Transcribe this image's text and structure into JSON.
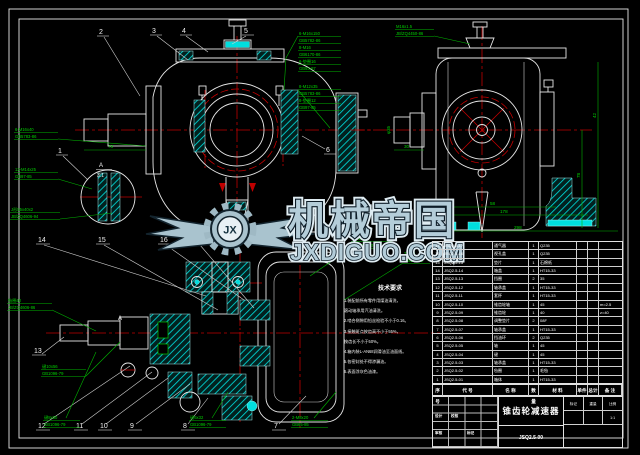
{
  "colors": {
    "background": "#000000",
    "outline": "#e6e6e6",
    "centerline": "#c00000",
    "annotation_green": "#00d000",
    "hatch_cyan": "#00dede",
    "watermark_blue": "#b4cdd9"
  },
  "watermark": {
    "brand": "机械帝国",
    "site": "JXDIGUO.COM",
    "monogram": "JX"
  },
  "views": {
    "front": {
      "balloons": [
        "1",
        "2",
        "3",
        "4",
        "5",
        "6"
      ],
      "detail": {
        "letter": "A",
        "scale": "3:1"
      },
      "dim_shaft": "78",
      "callouts": {
        "left1": [
          "6-M16x40",
          "GB5783-86"
        ],
        "left2": [
          "12-M14x25",
          "GB97-85"
        ],
        "left3": [
          "J形55x40x2",
          "JB/ZQ4606-94"
        ],
        "mid1": [
          "6-M16x150",
          "GB5782-86",
          "8-M16",
          "GB6170-86",
          "6-垫圈16",
          "GB93-87"
        ],
        "mid2": [
          "8-M12x35",
          "GB5783-86",
          "8-垫圈12",
          "GB97-85"
        ]
      }
    },
    "side": {
      "cap_callout": [
        "M16x1.5",
        "JB/ZQ4450-86"
      ],
      "dims": {
        "d42": "42",
        "d78": "78",
        "d58": "58",
        "d178": "178",
        "d298": "298",
        "d30": "30",
        "dphi": "φ35"
      }
    },
    "plan": {
      "section_label": "A",
      "balloon_13": "13",
      "balloons_top": [
        "14",
        "15",
        "16",
        "17"
      ],
      "balloons_bottom": [
        "12",
        "11",
        "10",
        "9",
        "8",
        "7"
      ],
      "callouts": {
        "left1": [
          "毡圈40",
          "JB/ZQ4606-86"
        ],
        "left2": [
          "键10x56",
          "GB1096-79"
        ],
        "bot1": [
          "键8x50",
          "GB1096-79"
        ],
        "bot2": [
          "键6x32",
          "GB1096-79"
        ],
        "bot3": [
          "2-M8x20",
          "GB65-85"
        ],
        "right1": [
          "M14x1.5",
          "JB/ZQ4450-86"
        ],
        "right2": [
          "2-φ10",
          "GB117-86"
        ]
      }
    }
  },
  "tech_req": {
    "title": "技术要求",
    "lines": [
      "1.装配前所有零件用煤油清洗，",
      "滚动轴承用汽油清洗。",
      "2.啮合侧隙用铅丝检验不小于0.16。",
      "3.接触斑点按齿高不小于55%，",
      "按齿长不小于50%。",
      "4.箱内装L-AN68润滑油至油面线。",
      "5.各密封处不得渗漏油。",
      "6.表面涂灰色油漆。"
    ]
  },
  "bom": {
    "headers": [
      "序号",
      "代  号",
      "名  称",
      "数量",
      "材  料",
      "单件",
      "总计",
      "备 注"
    ],
    "rows": [
      {
        "no": "17",
        "code": "JSQ2.5-17",
        "name": "通气器",
        "qty": "1",
        "mat": "Q235",
        "w1": "",
        "w2": "",
        "note": ""
      },
      {
        "no": "16",
        "code": "JSQ2.5-16",
        "name": "视孔盖",
        "qty": "1",
        "mat": "Q235",
        "w1": "",
        "w2": "",
        "note": ""
      },
      {
        "no": "15",
        "code": "JSQ2.5-15",
        "name": "垫片",
        "qty": "1",
        "mat": "石棉纸",
        "w1": "",
        "w2": "",
        "note": ""
      },
      {
        "no": "14",
        "code": "JSQ2.5-14",
        "name": "箱盖",
        "qty": "1",
        "mat": "HT15-33",
        "w1": "",
        "w2": "",
        "note": ""
      },
      {
        "no": "13",
        "code": "JSQ2.5-13",
        "name": "挡圈",
        "qty": "2",
        "mat": "35",
        "w1": "",
        "w2": "",
        "note": ""
      },
      {
        "no": "12",
        "code": "JSQ2.5-12",
        "name": "轴承盖",
        "qty": "1",
        "mat": "HT15-33",
        "w1": "",
        "w2": "",
        "note": ""
      },
      {
        "no": "11",
        "code": "JSQ2.5-11",
        "name": "套杯",
        "qty": "1",
        "mat": "HT15-33",
        "w1": "",
        "w2": "",
        "note": ""
      },
      {
        "no": "10",
        "code": "JSQ2.5-10",
        "name": "锥齿轮轴",
        "qty": "1",
        "mat": "45",
        "w1": "",
        "w2": "",
        "note": "m=2.5"
      },
      {
        "no": "9",
        "code": "JSQ2.5-09",
        "name": "锥齿轮",
        "qty": "1",
        "mat": "40",
        "w1": "",
        "w2": "",
        "note": "z=40"
      },
      {
        "no": "8",
        "code": "JSQ2.5-08",
        "name": "调整垫片",
        "qty": "2",
        "mat": "08F",
        "w1": "",
        "w2": "",
        "note": ""
      },
      {
        "no": "7",
        "code": "JSQ2.5-07",
        "name": "轴承盖",
        "qty": "1",
        "mat": "HT15-33",
        "w1": "",
        "w2": "",
        "note": ""
      },
      {
        "no": "6",
        "code": "JSQ2.5-06",
        "name": "挡油环",
        "qty": "2",
        "mat": "Q235",
        "w1": "",
        "w2": "",
        "note": ""
      },
      {
        "no": "5",
        "code": "JSQ2.5-05",
        "name": "轴",
        "qty": "1",
        "mat": "45",
        "w1": "",
        "w2": "",
        "note": ""
      },
      {
        "no": "4",
        "code": "JSQ2.5-04",
        "name": "键",
        "qty": "1",
        "mat": "45",
        "w1": "",
        "w2": "",
        "note": ""
      },
      {
        "no": "3",
        "code": "JSQ2.5-03",
        "name": "轴承盖",
        "qty": "1",
        "mat": "HT15-33",
        "w1": "",
        "w2": "",
        "note": ""
      },
      {
        "no": "2",
        "code": "JSQ2.5-02",
        "name": "毡圈",
        "qty": "1",
        "mat": "毛毡",
        "w1": "",
        "w2": "",
        "note": ""
      },
      {
        "no": "1",
        "code": "JSQ2.5-01",
        "name": "箱体",
        "qty": "1",
        "mat": "HT15-33",
        "w1": "",
        "w2": "",
        "note": ""
      }
    ]
  },
  "title_block": {
    "title": "锥齿轮减速器",
    "drawing_no": "JSQ2.5-00",
    "mark_label": "标记",
    "weight_label": "重量",
    "scale_label": "比例",
    "scale_value": "1:1",
    "design_label": "设计",
    "check_label": "校核",
    "approve_label": "审核"
  }
}
